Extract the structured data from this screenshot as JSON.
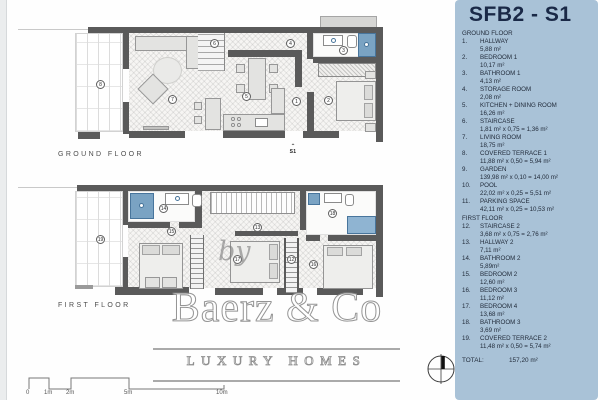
{
  "sidebar": {
    "title": "SFB2 - S1",
    "sections": [
      {
        "header": "GROUND FLOOR",
        "items": [
          {
            "num": "1.",
            "name": "HALLWAY",
            "area": "5,88 m²"
          },
          {
            "num": "2.",
            "name": "BEDROOM 1",
            "area": "10,17 m²"
          },
          {
            "num": "3.",
            "name": "BATHROOM 1",
            "area": "4,13 m²"
          },
          {
            "num": "4.",
            "name": "STORAGE ROOM",
            "area": "2,08 m²"
          },
          {
            "num": "5.",
            "name": "KITCHEN + DINING ROOM",
            "area": "16,26 m²"
          },
          {
            "num": "6.",
            "name": "STAIRCASE",
            "area": "1,81 m² x 0,75 = 1,36 m²"
          },
          {
            "num": "7.",
            "name": "LIVING ROOM",
            "area": "18,75 m²"
          },
          {
            "num": "8.",
            "name": "COVERED TERRACE 1",
            "area": "11,88 m² x 0,50 = 5,94 m²"
          },
          {
            "num": "9.",
            "name": "GARDEN",
            "area": "139,98 m² x 0,10 = 14,00 m²"
          },
          {
            "num": "10.",
            "name": "POOL",
            "area": "22,02 m² x 0,25 = 5,51 m²"
          },
          {
            "num": "11.",
            "name": "PARKING SPACE",
            "area": "42,11 m² x 0,25 = 10,53 m²"
          }
        ]
      },
      {
        "header": "FIRST FLOOR",
        "items": [
          {
            "num": "12.",
            "name": "STAIRCASE 2",
            "area": "3,68 m² x 0,75 = 2,76 m²"
          },
          {
            "num": "13.",
            "name": "HALLWAY 2",
            "area": "7,11 m²"
          },
          {
            "num": "14.",
            "name": "BATHROOM 2",
            "area": "5,89m²"
          },
          {
            "num": "15.",
            "name": "BEDROOM 2",
            "area": "12,60 m²"
          },
          {
            "num": "16.",
            "name": "BEDROOM 3",
            "area": "11,12 m²"
          },
          {
            "num": "17.",
            "name": "BEDROOM 4",
            "area": "13,68 m²"
          },
          {
            "num": "18.",
            "name": "BATHROOM 3",
            "area": "3,69 m²"
          },
          {
            "num": "19.",
            "name": "COVERED TERRACE 2",
            "area": "11,48 m² x 0,50 = 5,74 m²"
          }
        ]
      }
    ],
    "total_label": "TOTAL:",
    "total_value": "157,20 m²"
  },
  "plans": {
    "ground": {
      "label": "GROUND FLOOR",
      "entrance_label": "S1",
      "markers": {
        "hallway": "1",
        "bedroom1": "2",
        "bathroom1": "3",
        "storage": "4",
        "kitchen": "5",
        "staircase": "6",
        "living": "7",
        "terrace": "8"
      }
    },
    "first": {
      "label": "FIRST FLOOR",
      "markers": {
        "staircase": "12",
        "hallway": "13",
        "bathroom2": "14",
        "bedroom2": "15",
        "bedroom3": "16",
        "bedroom4": "17",
        "bathroom3": "18",
        "terrace": "19"
      }
    }
  },
  "watermark": {
    "prefix": "by",
    "brand": "Baerz & Co",
    "tagline": "LUXURY HOMES"
  },
  "scale_bar": {
    "labels": [
      "0",
      "1m",
      "2m",
      "5m",
      "10m"
    ]
  },
  "colors": {
    "sidebar_bg": "#a9c2d7",
    "title_text": "#1a2947",
    "wall": "#5a5a5a",
    "fixture_blue": "#7aa3c3",
    "watermark_gray": "#8d8d8d"
  }
}
